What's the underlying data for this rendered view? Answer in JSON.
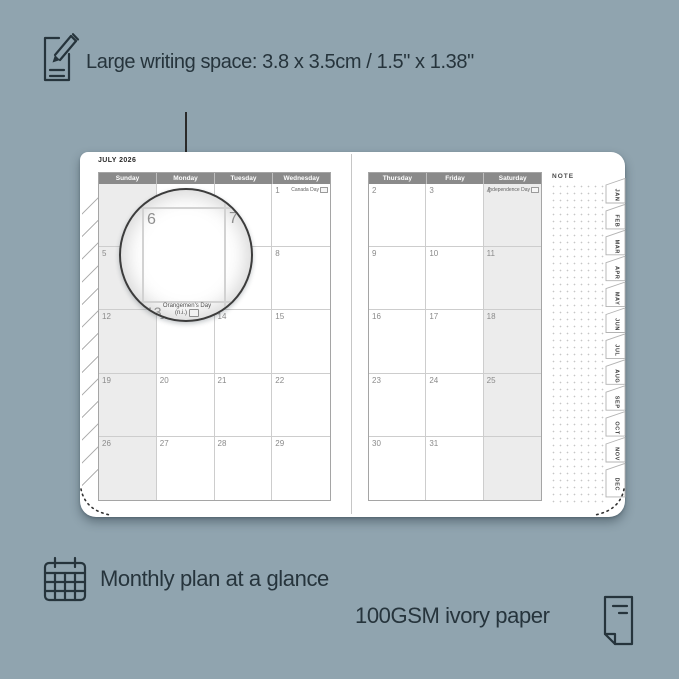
{
  "colors": {
    "background": "#90A4AF",
    "ink": "#26343C",
    "header_band": "#8a8a8a",
    "weekend_shade": "#ececec",
    "grid_line": "#cdcdcd",
    "dot_color": "#c6c6c6"
  },
  "top_annotation": {
    "label": "Large writing space: 3.8 x 3.5cm / 1.5\" x 1.38\""
  },
  "planner": {
    "month_title": "JULY 2026",
    "note_label": "NOTE",
    "left_page": {
      "day_headers": [
        "Sunday",
        "Monday",
        "Tuesday",
        "Wednesday"
      ],
      "cols": 4,
      "shaded_col": 0,
      "cells": [
        {},
        {},
        {},
        {
          "d": "1",
          "holiday": "Canada Day",
          "flag": true
        },
        {
          "d": "5"
        },
        {
          "d": "6"
        },
        {
          "d": "7"
        },
        {
          "d": "8"
        },
        {
          "d": "12"
        },
        {
          "d": "13"
        },
        {
          "d": "14"
        },
        {
          "d": "15"
        },
        {
          "d": "19"
        },
        {
          "d": "20"
        },
        {
          "d": "21"
        },
        {
          "d": "22"
        },
        {
          "d": "26"
        },
        {
          "d": "27"
        },
        {
          "d": "28"
        },
        {
          "d": "29"
        }
      ]
    },
    "right_page": {
      "day_headers": [
        "Thursday",
        "Friday",
        "Saturday"
      ],
      "cols": 3,
      "shaded_col": 2,
      "cells": [
        {
          "d": "2"
        },
        {
          "d": "3"
        },
        {
          "d": "4",
          "holiday": "Independence Day",
          "flag": true
        },
        {
          "d": "9"
        },
        {
          "d": "10"
        },
        {
          "d": "11"
        },
        {
          "d": "16"
        },
        {
          "d": "17"
        },
        {
          "d": "18"
        },
        {
          "d": "23"
        },
        {
          "d": "24"
        },
        {
          "d": "25"
        },
        {
          "d": "30"
        },
        {
          "d": "31"
        },
        {}
      ]
    },
    "month_tabs": [
      "JAN",
      "FEB",
      "MAR",
      "APR",
      "MAY",
      "JUN",
      "JUL",
      "AUG",
      "SEP",
      "OCT",
      "NOV",
      "DEC"
    ]
  },
  "magnifier": {
    "day_left": "6",
    "day_right": "7",
    "day_bottom": "13",
    "holiday_line1": "Orangemen's Day",
    "holiday_line2": "(n.i.)"
  },
  "bottom_annotations": {
    "monthly_label": "Monthly plan at a glance",
    "paper_label": "100GSM ivory paper"
  }
}
